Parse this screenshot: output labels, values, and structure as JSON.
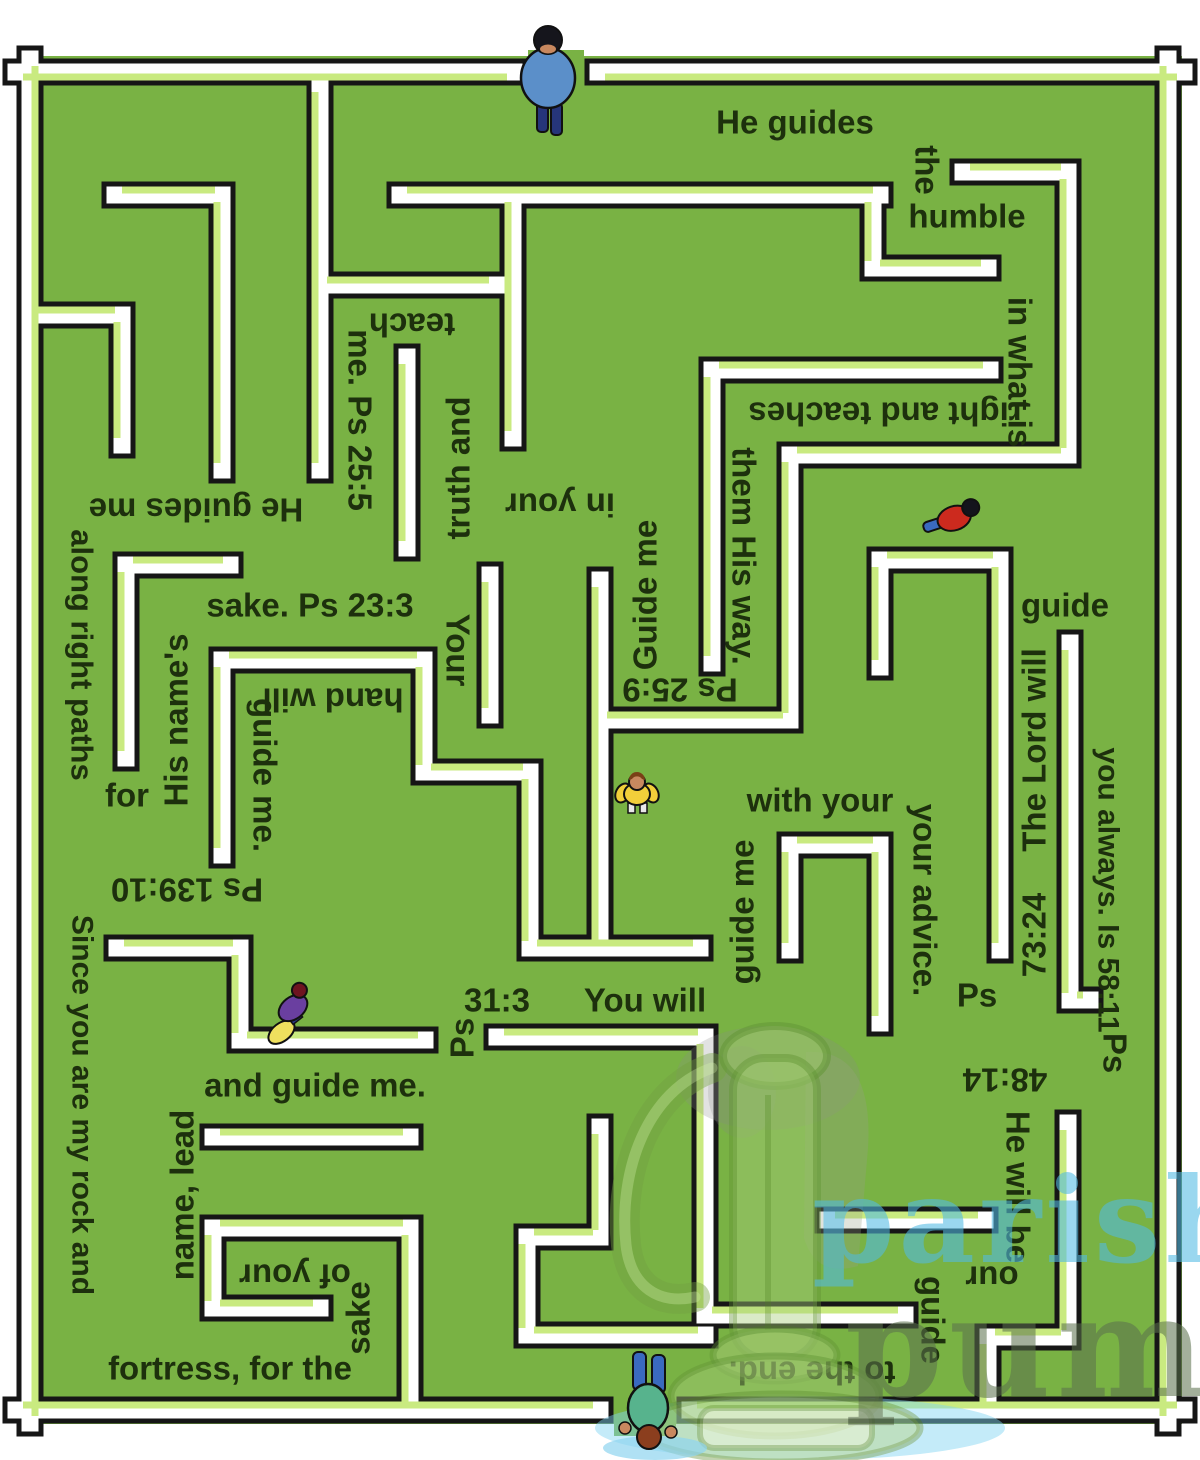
{
  "colors": {
    "field_green": "#79b244",
    "wall_white": "#ffffff",
    "wall_outline": "#161616",
    "bevel_green": "#c9ea80",
    "label_text": "#1d300d",
    "watermark_blue": "#52b9e3",
    "watermark_olive": "#5c714d",
    "watermark_gray": "#a3a3a3",
    "puddle_blue": "#7fd4f2"
  },
  "maze": {
    "labels": [
      {
        "t": "He guides",
        "x": 795,
        "y": 122,
        "r": 0,
        "s": 33
      },
      {
        "t": "the",
        "x": 927,
        "y": 170,
        "r": 90,
        "s": 33
      },
      {
        "t": "humble",
        "x": 967,
        "y": 216,
        "r": 0,
        "s": 33
      },
      {
        "t": "in what is",
        "x": 1020,
        "y": 372,
        "r": 90,
        "s": 33
      },
      {
        "t": "right and teaches",
        "x": 885,
        "y": 414,
        "r": 180,
        "s": 33
      },
      {
        "t": "them His way.",
        "x": 744,
        "y": 556,
        "r": 90,
        "s": 33
      },
      {
        "t": "Ps 25:9",
        "x": 680,
        "y": 690,
        "r": 180,
        "s": 33
      },
      {
        "t": "Guide me",
        "x": 645,
        "y": 595,
        "r": -90,
        "s": 33
      },
      {
        "t": "in your",
        "x": 560,
        "y": 505,
        "r": 180,
        "s": 33
      },
      {
        "t": "truth and",
        "x": 458,
        "y": 468,
        "r": -90,
        "s": 33
      },
      {
        "t": "teach",
        "x": 412,
        "y": 325,
        "r": 180,
        "s": 33
      },
      {
        "t": "me. Ps 25:5",
        "x": 360,
        "y": 420,
        "r": 90,
        "s": 33
      },
      {
        "t": "He guides me",
        "x": 196,
        "y": 510,
        "r": 180,
        "s": 33
      },
      {
        "t": "along right paths",
        "x": 82,
        "y": 655,
        "r": 90,
        "s": 31
      },
      {
        "t": "for",
        "x": 127,
        "y": 795,
        "r": 0,
        "s": 33
      },
      {
        "t": "His name's",
        "x": 176,
        "y": 720,
        "r": -90,
        "s": 33
      },
      {
        "t": "sake. Ps 23:3",
        "x": 310,
        "y": 605,
        "r": 0,
        "s": 33
      },
      {
        "t": "Your",
        "x": 458,
        "y": 650,
        "r": 90,
        "s": 33
      },
      {
        "t": "hand will",
        "x": 333,
        "y": 700,
        "r": 180,
        "s": 33
      },
      {
        "t": "guide me.",
        "x": 265,
        "y": 775,
        "r": 90,
        "s": 33
      },
      {
        "t": "Ps 139:10",
        "x": 187,
        "y": 890,
        "r": 180,
        "s": 33
      },
      {
        "t": "Since you are my rock and",
        "x": 82,
        "y": 1105,
        "r": 90,
        "s": 30
      },
      {
        "t": "fortress, for the",
        "x": 230,
        "y": 1368,
        "r": 0,
        "s": 33
      },
      {
        "t": "sake",
        "x": 358,
        "y": 1318,
        "r": -90,
        "s": 33
      },
      {
        "t": "of your",
        "x": 295,
        "y": 1276,
        "r": 180,
        "s": 33
      },
      {
        "t": "name, lead",
        "x": 182,
        "y": 1195,
        "r": -90,
        "s": 33
      },
      {
        "t": "and guide me.",
        "x": 315,
        "y": 1085,
        "r": 0,
        "s": 33
      },
      {
        "t": "Ps",
        "x": 462,
        "y": 1038,
        "r": -90,
        "s": 33
      },
      {
        "t": "31:3",
        "x": 497,
        "y": 1000,
        "r": 0,
        "s": 33
      },
      {
        "t": "You will",
        "x": 645,
        "y": 1000,
        "r": 0,
        "s": 33
      },
      {
        "t": "guide me",
        "x": 742,
        "y": 912,
        "r": -90,
        "s": 33
      },
      {
        "t": "with your",
        "x": 820,
        "y": 800,
        "r": 0,
        "s": 33
      },
      {
        "t": "your advice.",
        "x": 925,
        "y": 900,
        "r": 90,
        "s": 33
      },
      {
        "t": "Ps",
        "x": 977,
        "y": 995,
        "r": 0,
        "s": 33
      },
      {
        "t": "73:24",
        "x": 1034,
        "y": 935,
        "r": -90,
        "s": 33
      },
      {
        "t": "The Lord will",
        "x": 1034,
        "y": 750,
        "r": -90,
        "s": 33
      },
      {
        "t": "guide",
        "x": 1065,
        "y": 605,
        "r": 0,
        "s": 33
      },
      {
        "t": "you always. Is 58:11",
        "x": 1108,
        "y": 890,
        "r": 90,
        "s": 30
      },
      {
        "t": "Ps",
        "x": 1115,
        "y": 1053,
        "r": 90,
        "s": 33
      },
      {
        "t": "48:14",
        "x": 1005,
        "y": 1080,
        "r": 180,
        "s": 33
      },
      {
        "t": "He will be",
        "x": 1018,
        "y": 1187,
        "r": 90,
        "s": 33
      },
      {
        "t": "our",
        "x": 992,
        "y": 1278,
        "r": 180,
        "s": 33
      },
      {
        "t": "guide",
        "x": 933,
        "y": 1320,
        "r": 90,
        "s": 33
      },
      {
        "t": "to the end.",
        "x": 812,
        "y": 1373,
        "r": 180,
        "s": 33
      }
    ],
    "walls": [
      {
        "pts": [
          [
            16,
            72
          ],
          [
            514,
            72
          ]
        ],
        "bevel": "br"
      },
      {
        "pts": [
          [
            598,
            72
          ],
          [
            1184,
            72
          ]
        ],
        "bevel": "br"
      },
      {
        "pts": [
          [
            30,
            59
          ],
          [
            30,
            1423
          ]
        ],
        "bevel": "br"
      },
      {
        "pts": [
          [
            1168,
            59
          ],
          [
            1168,
            1423
          ]
        ],
        "bevel": "tl"
      },
      {
        "pts": [
          [
            16,
            1410
          ],
          [
            600,
            1410
          ]
        ],
        "bevel": "tl"
      },
      {
        "pts": [
          [
            690,
            1410
          ],
          [
            1184,
            1410
          ]
        ],
        "bevel": "tl"
      },
      {
        "pts": [
          [
            115,
            195
          ],
          [
            222,
            195
          ],
          [
            222,
            470
          ]
        ],
        "bevel": "tl"
      },
      {
        "pts": [
          [
            30,
            315
          ],
          [
            122,
            315
          ],
          [
            122,
            445
          ]
        ],
        "bevel": "tl"
      },
      {
        "pts": [
          [
            320,
            85
          ],
          [
            320,
            470
          ]
        ],
        "bevel": "tl"
      },
      {
        "pts": [
          [
            320,
            285
          ],
          [
            496,
            285
          ]
        ],
        "bevel": "tl"
      },
      {
        "pts": [
          [
            400,
            195
          ],
          [
            880,
            195
          ]
        ],
        "bevel": "tl"
      },
      {
        "pts": [
          [
            513,
            195
          ],
          [
            513,
            438
          ]
        ],
        "bevel": "tl"
      },
      {
        "pts": [
          [
            407,
            357
          ],
          [
            407,
            548
          ]
        ],
        "bevel": "tl"
      },
      {
        "pts": [
          [
            490,
            575
          ],
          [
            490,
            715
          ]
        ],
        "bevel": "tl"
      },
      {
        "pts": [
          [
            600,
            580
          ],
          [
            600,
            948
          ]
        ],
        "bevel": "tl"
      },
      {
        "pts": [
          [
            963,
            172
          ],
          [
            1068,
            172
          ],
          [
            1068,
            455
          ],
          [
            790,
            455
          ],
          [
            790,
            720
          ],
          [
            600,
            720
          ]
        ],
        "bevel": "tl"
      },
      {
        "pts": [
          [
            873,
            195
          ],
          [
            873,
            268
          ],
          [
            988,
            268
          ]
        ],
        "bevel": "tl"
      },
      {
        "pts": [
          [
            990,
            370
          ],
          [
            712,
            370
          ],
          [
            712,
            663
          ]
        ],
        "bevel": "tl"
      },
      {
        "pts": [
          [
            880,
            667
          ],
          [
            880,
            560
          ],
          [
            1000,
            560
          ],
          [
            1000,
            950
          ]
        ],
        "bevel": "tl"
      },
      {
        "pts": [
          [
            1070,
            643
          ],
          [
            1070,
            1000
          ],
          [
            1090,
            1000
          ]
        ],
        "bevel": "tl"
      },
      {
        "pts": [
          [
            790,
            950
          ],
          [
            790,
            845
          ],
          [
            880,
            845
          ],
          [
            880,
            1023
          ]
        ],
        "bevel": "tl"
      },
      {
        "pts": [
          [
            222,
            855
          ],
          [
            222,
            660
          ],
          [
            424,
            660
          ],
          [
            424,
            772
          ],
          [
            530,
            772
          ],
          [
            530,
            948
          ],
          [
            700,
            948
          ]
        ],
        "bevel": "tl"
      },
      {
        "pts": [
          [
            230,
            565
          ],
          [
            126,
            565
          ],
          [
            126,
            758
          ]
        ],
        "bevel": "tl"
      },
      {
        "pts": [
          [
            117,
            948
          ],
          [
            240,
            948
          ],
          [
            240,
            1040
          ],
          [
            425,
            1040
          ]
        ],
        "bevel": "tl"
      },
      {
        "pts": [
          [
            497,
            1037
          ],
          [
            705,
            1037
          ],
          [
            705,
            1315
          ],
          [
            905,
            1315
          ]
        ],
        "bevel": "tl"
      },
      {
        "pts": [
          [
            828,
            1220
          ],
          [
            985,
            1220
          ]
        ],
        "bevel": "tl"
      },
      {
        "pts": [
          [
            1068,
            1123
          ],
          [
            1068,
            1337
          ],
          [
            988,
            1337
          ],
          [
            988,
            1410
          ]
        ],
        "bevel": "tl"
      },
      {
        "pts": [
          [
            600,
            1127
          ],
          [
            600,
            1237
          ],
          [
            527,
            1237
          ],
          [
            527,
            1335
          ],
          [
            705,
            1335
          ]
        ],
        "bevel": "tl"
      },
      {
        "pts": [
          [
            213,
            1137
          ],
          [
            410,
            1137
          ]
        ],
        "bevel": "tl"
      },
      {
        "pts": [
          [
            410,
            1228
          ],
          [
            213,
            1228
          ],
          [
            213,
            1308
          ],
          [
            320,
            1308
          ]
        ],
        "bevel": "tl"
      },
      {
        "pts": [
          [
            410,
            1228
          ],
          [
            410,
            1410
          ]
        ],
        "bevel": "tl"
      }
    ],
    "openings": [
      {
        "x": 528,
        "y": 50,
        "w": 56,
        "h": 40
      },
      {
        "x": 614,
        "y": 1396,
        "w": 62,
        "h": 40
      }
    ],
    "figures": [
      {
        "name": "walker-entrance",
        "x": 548,
        "y": 78,
        "shirt": "#5b8fc9",
        "pants": "#26357a",
        "hair": "#15151c",
        "skin": "#c8885f"
      },
      {
        "name": "walker-red",
        "x": 958,
        "y": 517,
        "shirt": "#cc2a1e",
        "pants": "#3a6abf",
        "hair": "#14141c"
      },
      {
        "name": "walker-yellow",
        "x": 637,
        "y": 791,
        "shirt": "#f2cf3a",
        "hair": "#7a4016",
        "skin": "#c8885f",
        "legs": "#e8e8e8"
      },
      {
        "name": "walker-purple",
        "x": 293,
        "y": 1008,
        "shirt": "#6a3fa0",
        "bag": "#efe05e",
        "hair": "#6e1420",
        "pants": "#2a3a8a"
      },
      {
        "name": "walker-exit",
        "x": 648,
        "y": 1405,
        "shirt": "#57b38d",
        "pants": "#3a6abf",
        "hair": "#8b3e1e",
        "skin": "#c8885f"
      }
    ],
    "watermark": {
      "word1": "parish",
      "word2_a": "pum",
      "word2_b": "p"
    }
  }
}
